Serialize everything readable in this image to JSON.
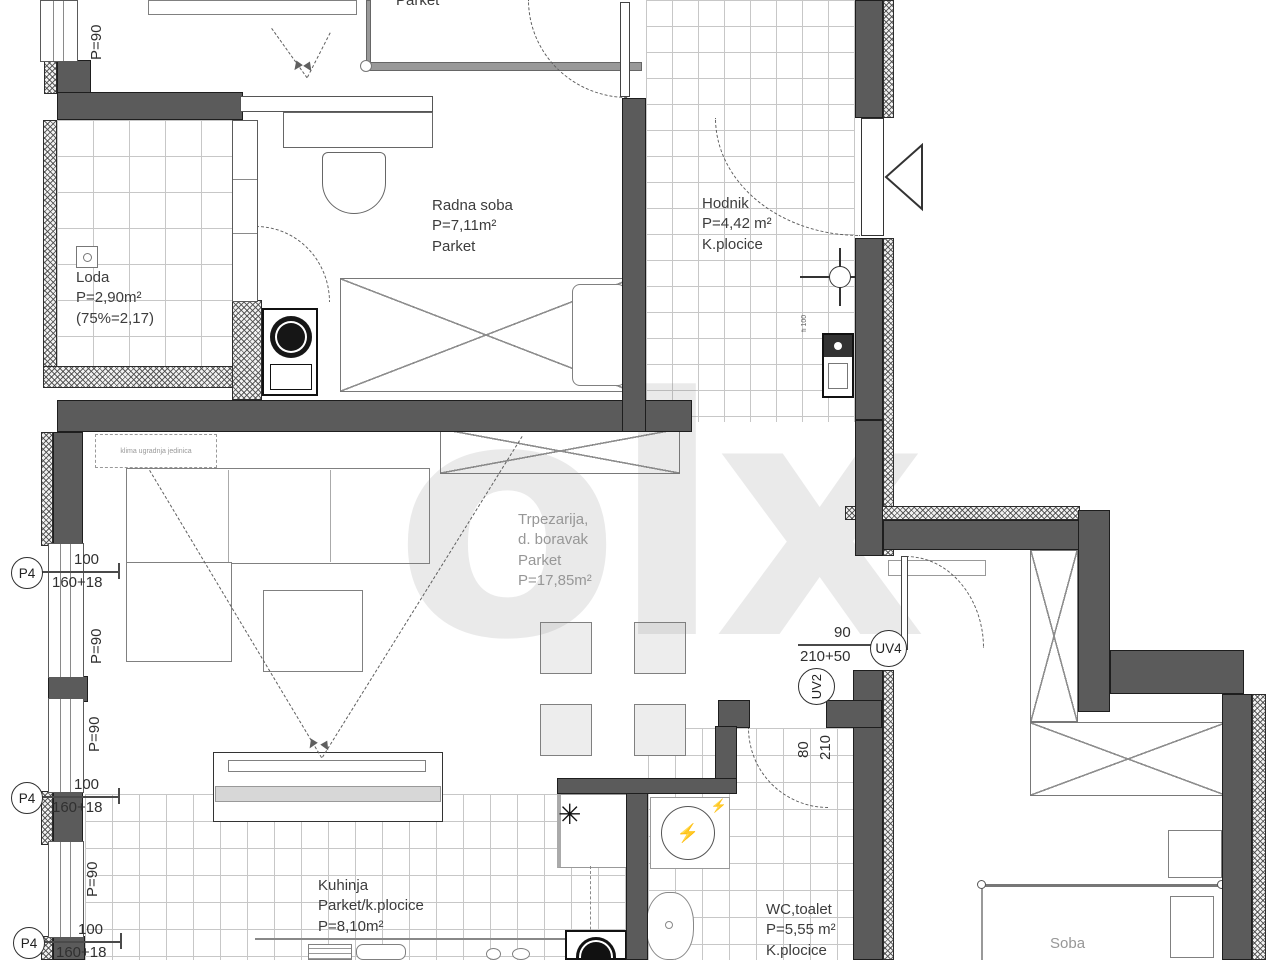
{
  "watermark": {
    "text": "olx"
  },
  "rooms": {
    "radna_soba": {
      "name": "Radna soba",
      "area": "P=7,11m²",
      "floor": "Parket"
    },
    "hodnik": {
      "name": "Hodnik",
      "area": "P=4,42 m²",
      "floor": "K.plocice"
    },
    "loda": {
      "name": "Loda",
      "area": "P=2,90m²",
      "note": "(75%=2,17)"
    },
    "trpezarija": {
      "name": "Trpezarija,",
      "name2": "d. boravak",
      "floor": "Parket",
      "area": "P=17,85m²"
    },
    "kuhinja": {
      "name": "Kuhinja",
      "floor": "Parket/k.plocice",
      "area": "P=8,10m²"
    },
    "wc": {
      "name": "WC,toalet",
      "area": "P=5,55 m²",
      "floor": "K.plocice"
    },
    "soba": {
      "name": "Soba"
    },
    "top_room": {
      "floor": "Parket"
    }
  },
  "dimensions": {
    "p90": "P=90",
    "width100": "100",
    "height160": "160+18",
    "door_uv4_w": "90",
    "door_uv4_h": "210+50",
    "door_uv2_w": "80",
    "door_uv2_h": "210"
  },
  "markers": {
    "p4": "P4",
    "uv4": "UV4",
    "uv2": "UV2"
  },
  "annotations": {
    "ac_unit": "klima ugradnja jedinica",
    "vent_pipe": "fi 100"
  },
  "symbols": {
    "boiler_star": "✳",
    "power": "⚡"
  },
  "colors": {
    "wall": "#5b5b5b",
    "tile_line": "#c7c7c7",
    "text": "#3c3c3c"
  }
}
